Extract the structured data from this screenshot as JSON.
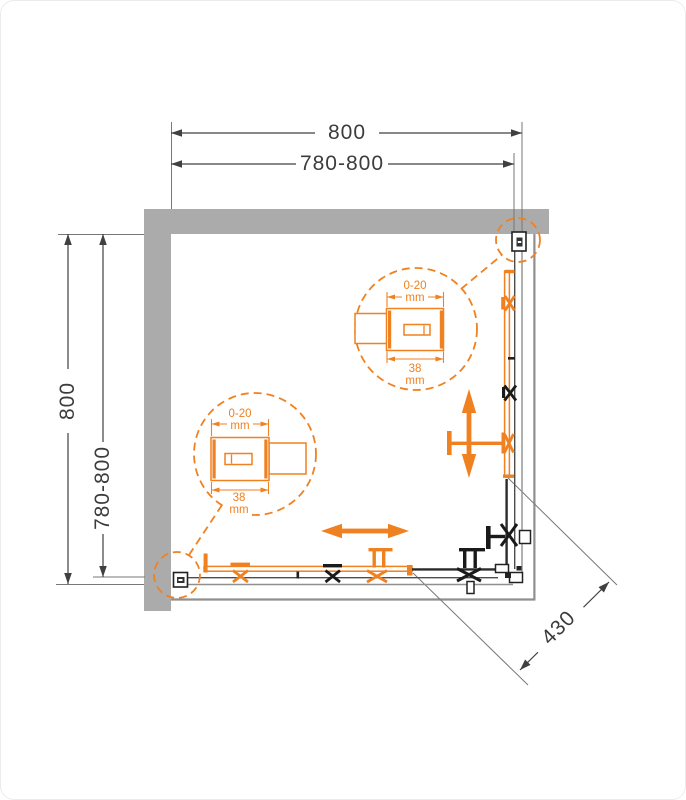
{
  "diagram": {
    "kind": "shower-enclosure-top-view-installation-drawing",
    "dimensions": {
      "top_outer": "800",
      "top_inner": "780-800",
      "left_outer": "800",
      "left_inner": "780-800",
      "entry_diagonal": "430"
    },
    "detail_top": {
      "adjustment_range": "0-20",
      "adjustment_unit": "mm",
      "profile_width": "38",
      "profile_width_unit": "mm"
    },
    "detail_bottom": {
      "adjustment_range": "0-20",
      "adjustment_unit": "mm",
      "profile_width": "38",
      "profile_width_unit": "mm"
    },
    "colors": {
      "accent_orange": "#F08121",
      "wall_gray": "#ABABAB",
      "line_dark": "#3F3F3F",
      "hardware_black": "#1A1A1A"
    }
  }
}
